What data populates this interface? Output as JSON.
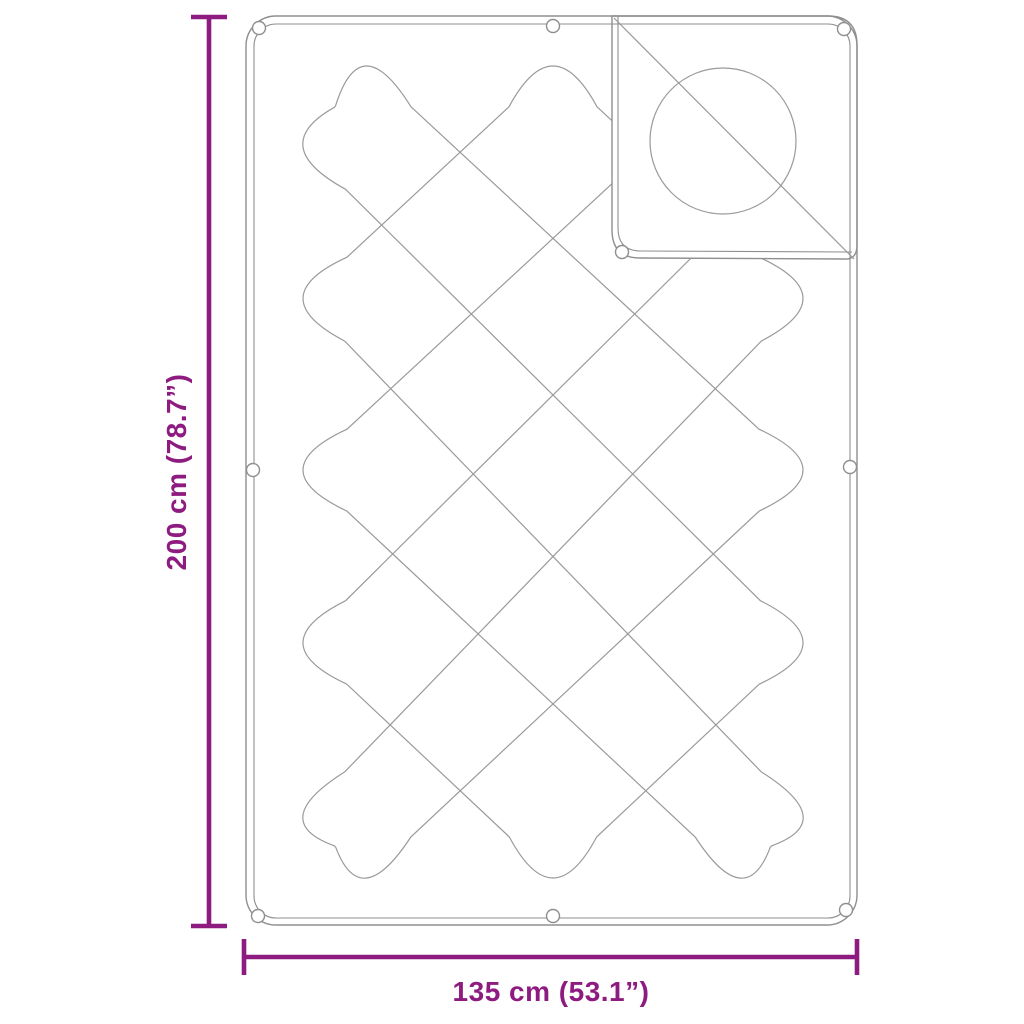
{
  "diagram": {
    "product": "quilted-blanket-with-corner-flap",
    "height_label": "200 cm (78.7”)",
    "width_label": "135 cm (53.1”)",
    "colors": {
      "dimension_accent": "#8E1B80",
      "drawing_line": "#8F8F8F",
      "background": "#FFFFFF"
    }
  }
}
